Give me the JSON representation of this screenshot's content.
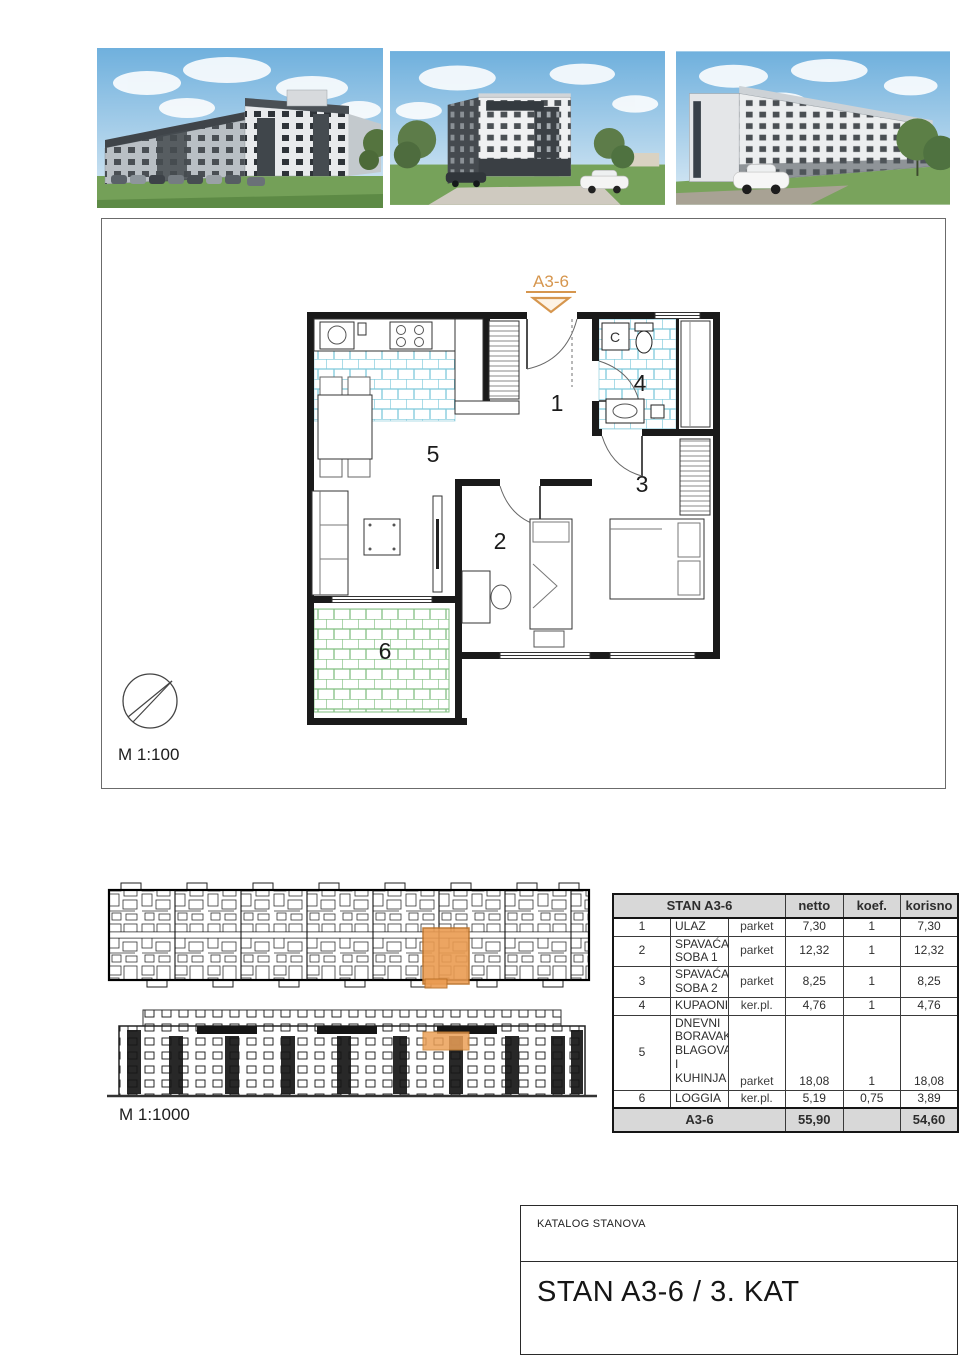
{
  "colors": {
    "accent_orange": "#d6964e",
    "highlight_orange": "#eb9c52",
    "tile_blue": "#7ec9db",
    "tile_green": "#82bf82",
    "table_header_bg": "#d8d8d8"
  },
  "floor_plan": {
    "unit_label": "A3-6",
    "scale_label": "M 1:100",
    "washer_label": "C",
    "rooms": [
      {
        "number": "1"
      },
      {
        "number": "2"
      },
      {
        "number": "3"
      },
      {
        "number": "4"
      },
      {
        "number": "5"
      },
      {
        "number": "6"
      }
    ]
  },
  "site_plan": {
    "scale_label": "M 1:1000"
  },
  "area_table": {
    "title": "STAN A3-6",
    "columns": {
      "netto": "netto",
      "koef": "koef.",
      "korisno": "korisno"
    },
    "rows": [
      {
        "num": "1",
        "name": "ULAZ",
        "material": "parket",
        "netto": "7,30",
        "koef": "1",
        "korisno": "7,30"
      },
      {
        "num": "2",
        "name": "SPAVAĆA SOBA 1",
        "material": "parket",
        "netto": "12,32",
        "koef": "1",
        "korisno": "12,32"
      },
      {
        "num": "3",
        "name": "SPAVAĆA SOBA 2",
        "material": "parket",
        "netto": "8,25",
        "koef": "1",
        "korisno": "8,25"
      },
      {
        "num": "4",
        "name": "KUPAONICA",
        "material": "ker.pl.",
        "netto": "4,76",
        "koef": "1",
        "korisno": "4,76"
      },
      {
        "num": "5",
        "name": "DNEVNI BORAVAK, BLAGOVAONA I KUHINJA",
        "material": "parket",
        "netto": "18,08",
        "koef": "1",
        "korisno": "18,08"
      },
      {
        "num": "6",
        "name": "LOGGIA",
        "material": "ker.pl.",
        "netto": "5,19",
        "koef": "0,75",
        "korisno": "3,89"
      }
    ],
    "total": {
      "label": "A3-6",
      "netto": "55,90",
      "koef": "",
      "korisno": "54,60"
    }
  },
  "title_block": {
    "catalog_label": "KATALOG STANOVA",
    "unit_title": "STAN A3-6 / 3. KAT"
  }
}
